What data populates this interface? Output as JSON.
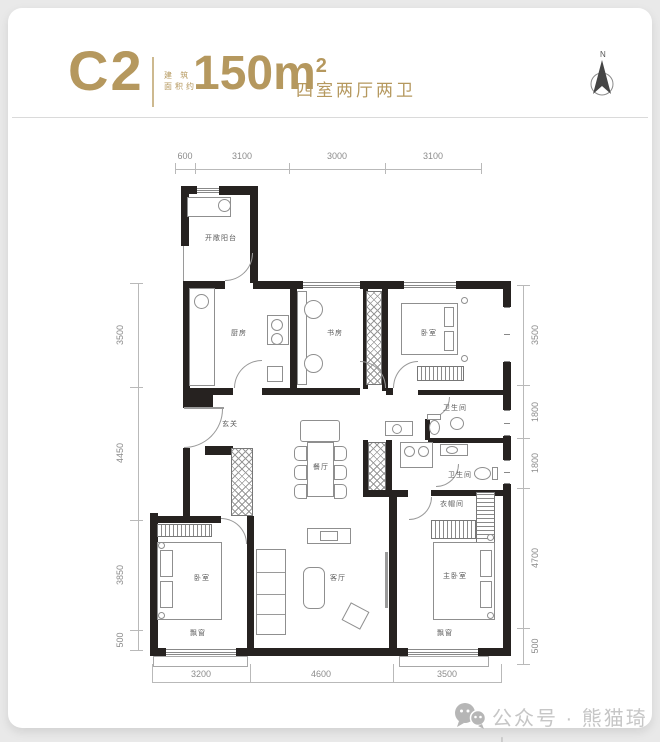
{
  "header": {
    "plan_code": "C2",
    "area_prefix_top": "建 筑",
    "area_prefix_bottom": "面积约",
    "area_value": "150m",
    "area_sup": "2",
    "layout_text": "四室两厅两卫",
    "compass_n": "N"
  },
  "dimensions": {
    "top": [
      "600",
      "3100",
      "3000",
      "3100"
    ],
    "left": [
      "3500",
      "4450",
      "3850",
      "500"
    ],
    "right": [
      "3500",
      "1800",
      "1800",
      "4700",
      "500"
    ],
    "bottom": [
      "3200",
      "4600",
      "3500"
    ]
  },
  "rooms": {
    "balcony": "开敞阳台",
    "kitchen": "厨房",
    "study": "书房",
    "bedroom_top": "卧室",
    "bath_upper": "卫生间",
    "foyer": "玄关",
    "dining": "餐厅",
    "bath_lower": "卫生间",
    "cloakroom": "衣帽间",
    "bedroom_left": "卧室",
    "living": "客厅",
    "master_bedroom": "主卧室",
    "bay_window_left": "飘窗",
    "bay_window_right": "飘窗"
  },
  "colors": {
    "accent": "#b5985e",
    "wall": "#262220",
    "dimension_line": "#b9b9b9",
    "watermark": "#c6c6c6"
  },
  "watermark": {
    "text": "公众号 · 熊猫琦士"
  }
}
